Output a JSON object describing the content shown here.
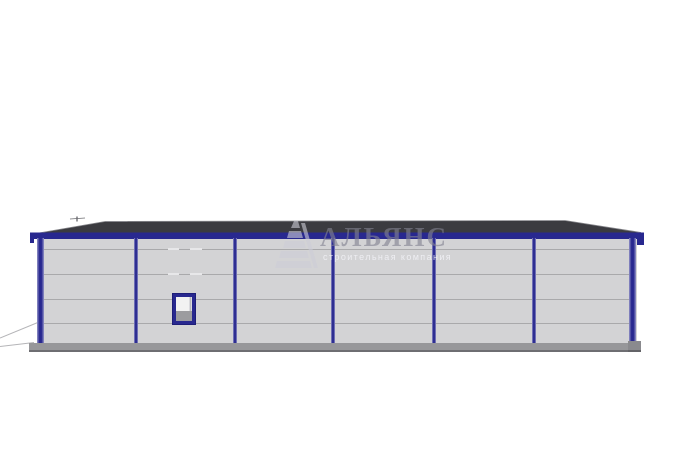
{
  "scene": {
    "description": "3D elevation render of a single-storey prefabricated warehouse building",
    "background": "#ffffff"
  },
  "watermark": {
    "title": "АЛЬЯНС",
    "subtitle": "строительная компания",
    "logo": "striped-pyramid"
  },
  "building": {
    "bays": 6,
    "columns": 7,
    "panel_rows": 5,
    "window": {
      "present": true,
      "bay_from_left": 2
    },
    "colors": {
      "frame_blue": "#28288f",
      "wall_gray": "#d3d3d5",
      "roof_dark": "#3b3b40",
      "seam_gray": "#a9a9ab",
      "base_gray": "#97979a"
    }
  }
}
